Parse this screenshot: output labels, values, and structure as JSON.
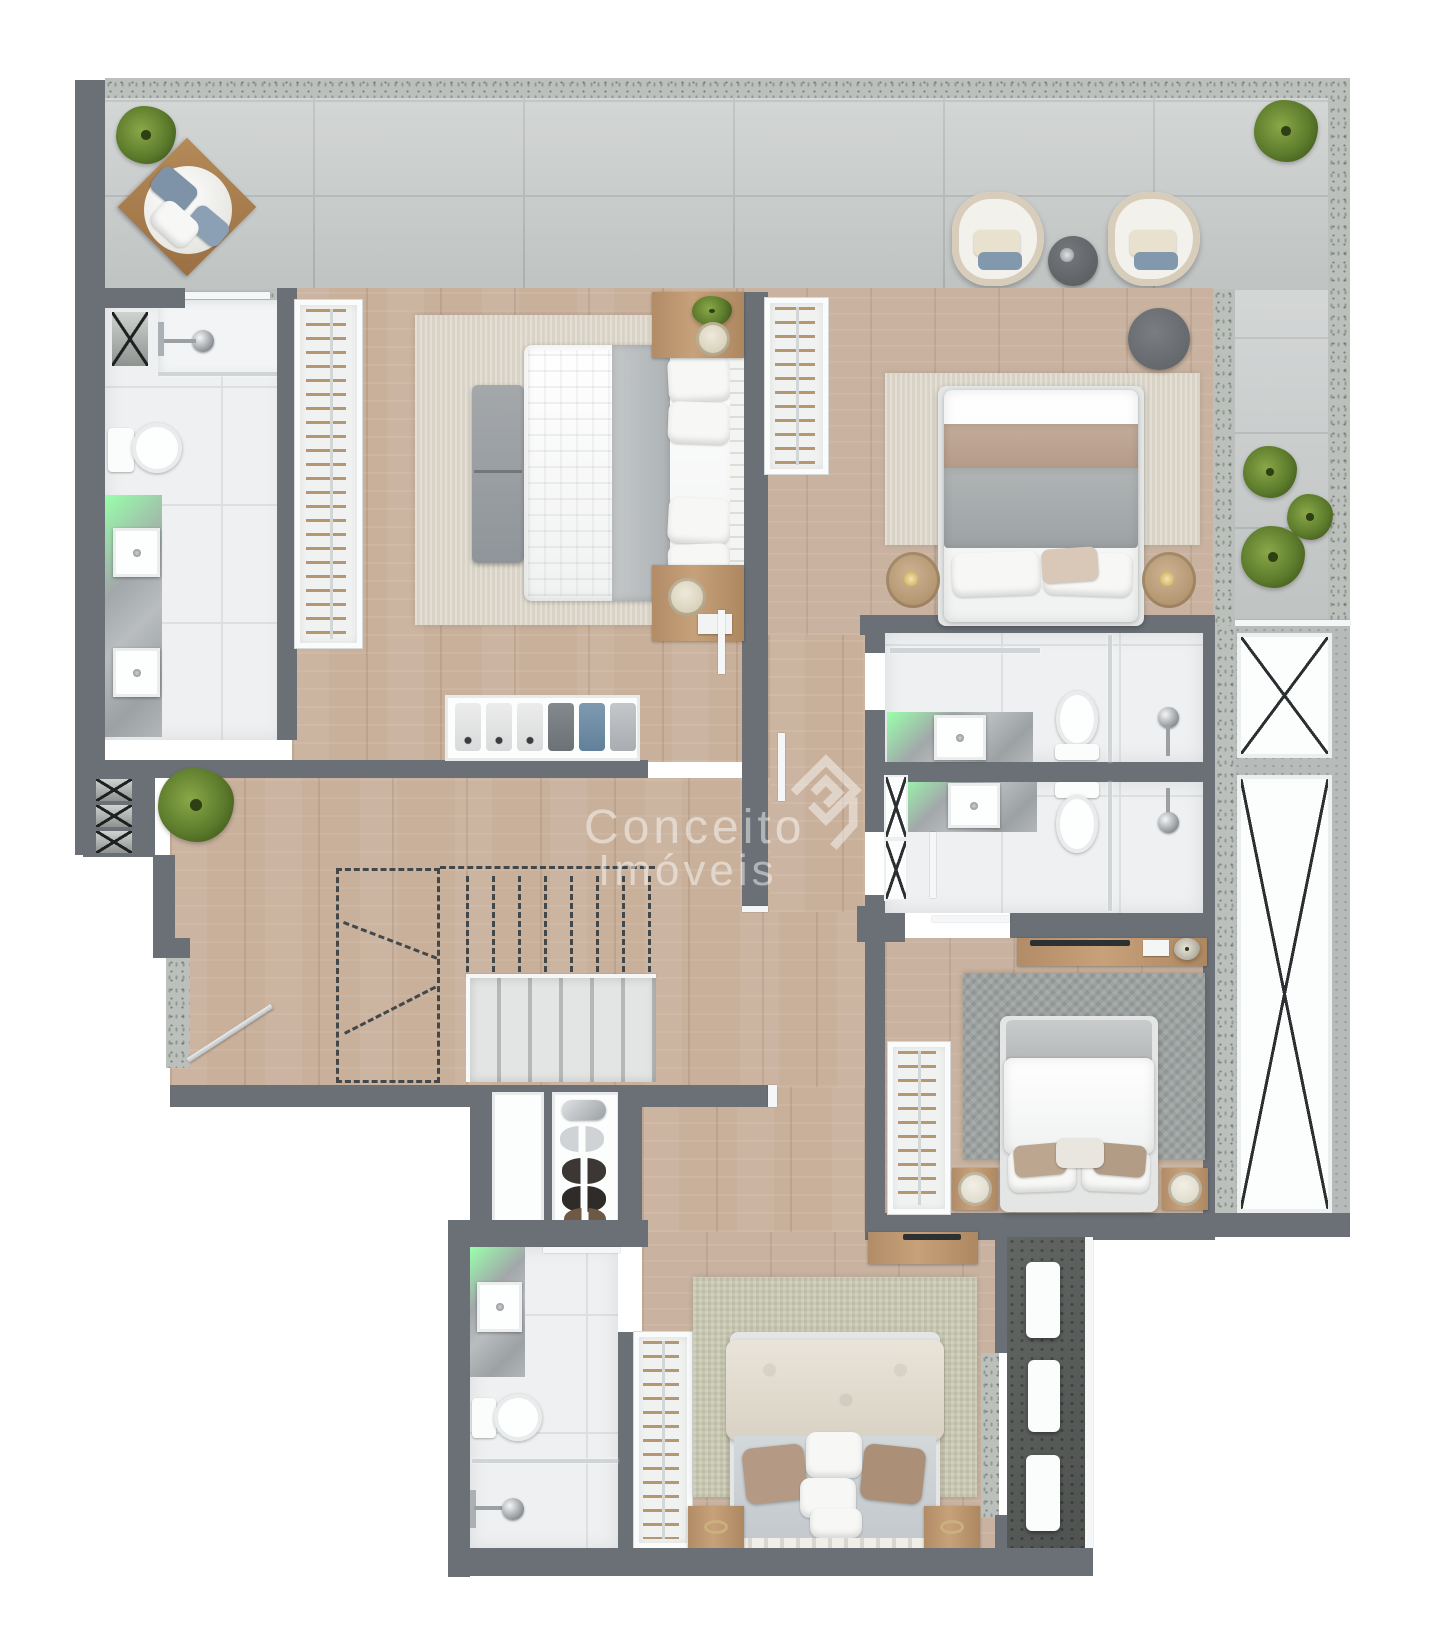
{
  "watermark": {
    "line1": "Conceito",
    "line2": "Imóveis"
  },
  "palette": {
    "wall": "#6a7076",
    "wood": "#c8b09b",
    "tile": "#c7cbca",
    "speckle": "#bcc0bc",
    "bath": "#eef0f1",
    "marble": "#a9adb0",
    "dark": "#595d5a",
    "green": "#5f7d2f",
    "accentBlue": "#7e93a8",
    "accentTaupe": "#b49a85"
  },
  "plan": {
    "type": "residential-floor-plan",
    "rooms": [
      "terrace",
      "master-bedroom",
      "master-bathroom",
      "bedroom-2",
      "bathroom-2",
      "bathroom-3",
      "hall-stairs",
      "suite-2-bedroom",
      "bedroom-3",
      "bathroom-4",
      "service-terrace",
      "shaft"
    ]
  }
}
